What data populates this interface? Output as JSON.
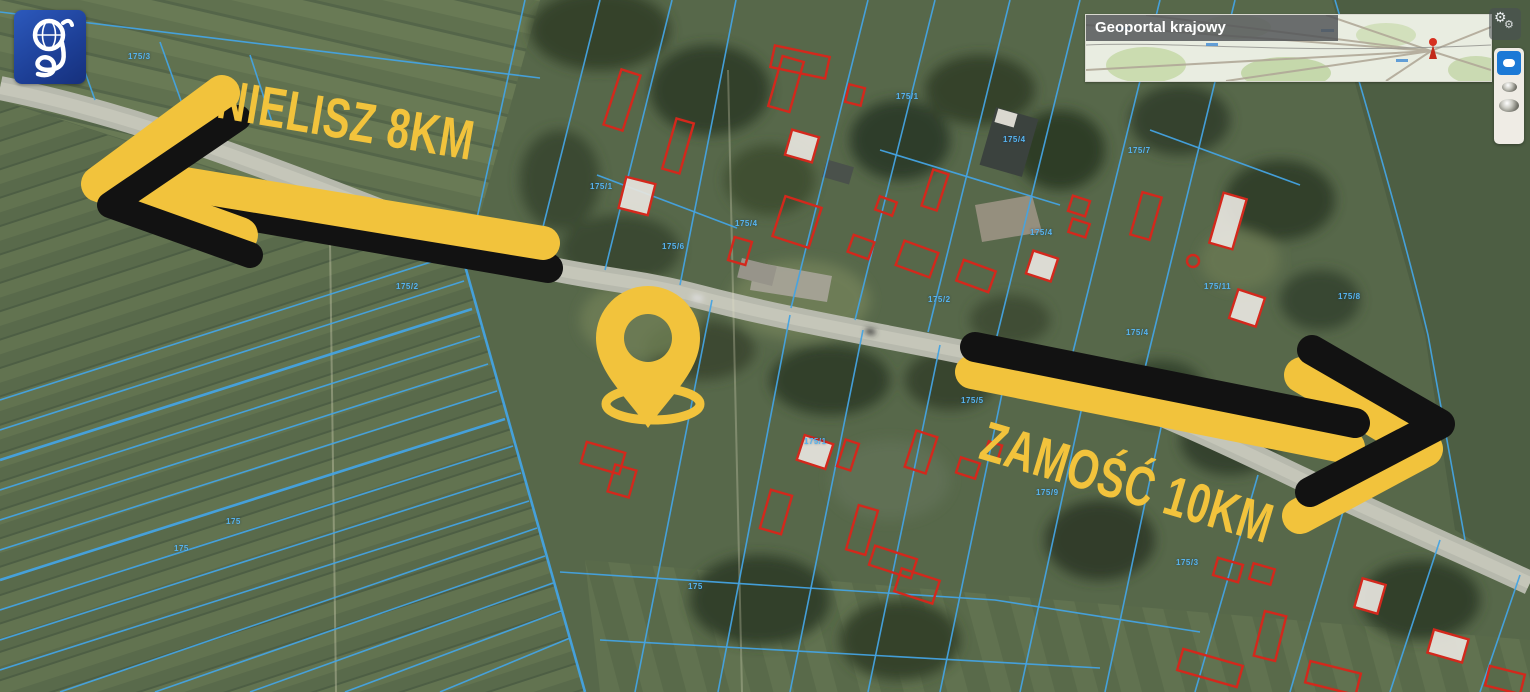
{
  "app": {
    "name": "Geoportal krajowy"
  },
  "annotations": {
    "destination_left": {
      "text": "NIELISZ 8KM",
      "direction": "left"
    },
    "destination_right": {
      "text": "ZAMOŚĆ 10KM",
      "direction": "right"
    },
    "location_pin": {
      "icon": "location-pin-icon"
    }
  },
  "minimap": {
    "title": "Geoportal krajowy",
    "marker_icon": "red-marker-icon"
  },
  "logo": {
    "letter": "g",
    "icon": "geoportal-g-icon"
  },
  "controls": {
    "tools_button_icon": "gears-icon",
    "panel_buttons": [
      {
        "icon": "active-dot-icon",
        "state": "active"
      },
      {
        "icon": "sphere-small-icon",
        "state": "normal"
      },
      {
        "icon": "sphere-large-icon",
        "state": "normal"
      }
    ]
  },
  "colors": {
    "annotation_yellow": "#f2c33c",
    "annotation_black": "#121212",
    "parcel_blue": "#44a3e2",
    "building_red": "#d3281c",
    "road_gray": "#b7b9ad",
    "field_green": "#57684a",
    "active_button_blue": "#1b79d6"
  },
  "parcel_labels": [
    {
      "text": "175/3",
      "x": 128,
      "y": 52
    },
    {
      "text": "175/2",
      "x": 396,
      "y": 282
    },
    {
      "text": "175/1",
      "x": 590,
      "y": 182
    },
    {
      "text": "175/4",
      "x": 735,
      "y": 219
    },
    {
      "text": "175/6",
      "x": 662,
      "y": 242
    },
    {
      "text": "175/1",
      "x": 896,
      "y": 92
    },
    {
      "text": "175/4",
      "x": 1003,
      "y": 135
    },
    {
      "text": "175/7",
      "x": 1128,
      "y": 146
    },
    {
      "text": "175/2",
      "x": 928,
      "y": 295
    },
    {
      "text": "175/4",
      "x": 1030,
      "y": 228
    },
    {
      "text": "175/11",
      "x": 1204,
      "y": 282
    },
    {
      "text": "175/4",
      "x": 1126,
      "y": 328
    },
    {
      "text": "175/8",
      "x": 1338,
      "y": 292
    },
    {
      "text": "175/5",
      "x": 961,
      "y": 396
    },
    {
      "text": "175/9",
      "x": 1036,
      "y": 488
    },
    {
      "text": "175/1",
      "x": 804,
      "y": 437
    },
    {
      "text": "175/3",
      "x": 1176,
      "y": 558
    },
    {
      "text": "175",
      "x": 174,
      "y": 544
    },
    {
      "text": "175",
      "x": 226,
      "y": 517
    },
    {
      "text": "175",
      "x": 688,
      "y": 582
    }
  ]
}
